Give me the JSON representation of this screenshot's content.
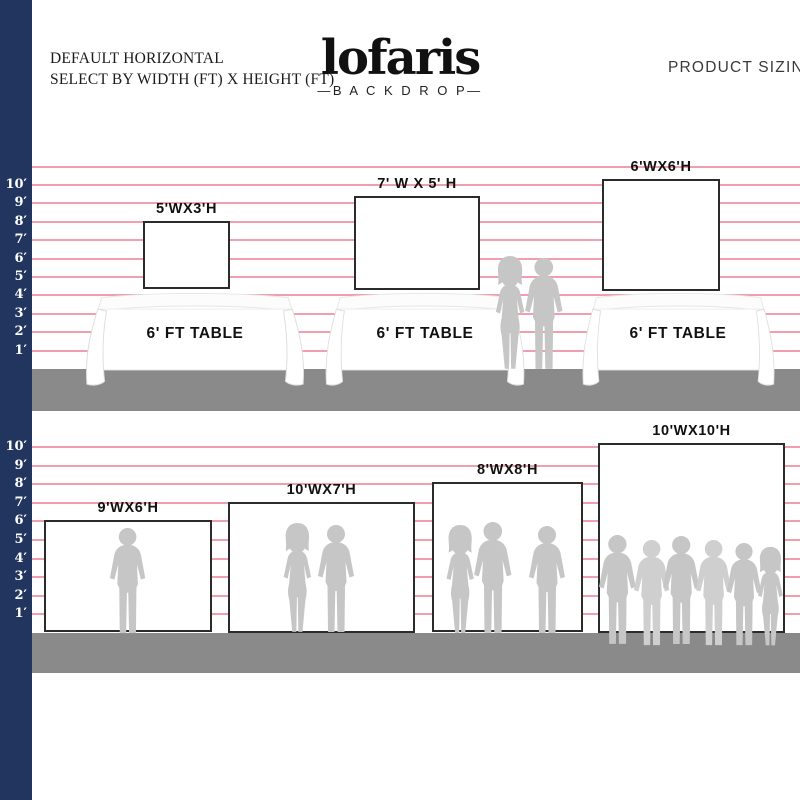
{
  "header": {
    "left_line1": "DEFAULT HORIZONTAL",
    "left_line2": "SELECT BY WIDTH (FT) X HEIGHT (FT)",
    "logo": "lofaris",
    "logo_sub": "—B A C K D R O P—",
    "right": "PRODUCT SIZING"
  },
  "colors": {
    "navy": "#22355f",
    "pink": "#ef9fae",
    "floor": "#8a8a8a",
    "silhouette": "#c6c6c6",
    "border": "#2b2b2b"
  },
  "ruler": {
    "labels": [
      "10′",
      "9′",
      "8′",
      "7′",
      "6′",
      "5′",
      "4′",
      "3′",
      "2′",
      "1′"
    ]
  },
  "sections": [
    {
      "id": "tables-row",
      "floor_top": 369,
      "floor_height": 42,
      "foot_px": 18.4,
      "feet_lines": 11,
      "backdrops": [
        {
          "label": "5'WX3'H",
          "x": 143,
          "y": 221,
          "w": 87,
          "h": 68
        },
        {
          "label": "7' W X 5' H",
          "x": 354,
          "y": 196,
          "w": 126,
          "h": 94
        },
        {
          "label": "6'WX6'H",
          "x": 602,
          "y": 179,
          "w": 118,
          "h": 112
        }
      ],
      "tables": [
        {
          "label": "6' FT TABLE",
          "cx": 195,
          "base_w": 214
        },
        {
          "label": "6' FT TABLE",
          "cx": 425,
          "base_w": 194
        },
        {
          "label": "6' FT TABLE",
          "cx": 678,
          "base_w": 187
        }
      ],
      "table_top_y": 292,
      "table_height": 95,
      "table_label_y": 325,
      "people": [
        {
          "type": "woman",
          "cx": 510,
          "top": 255,
          "h": 118
        },
        {
          "type": "man",
          "cx": 544,
          "top": 257,
          "h": 116
        }
      ]
    },
    {
      "id": "backdrops-row",
      "floor_top": 633,
      "floor_height": 40,
      "foot_px": 18.6,
      "feet_lines": 10,
      "backdrops": [
        {
          "label": "9'WX6'H",
          "x": 44,
          "y": 520,
          "w": 168,
          "h": 112
        },
        {
          "label": "10'WX7'H",
          "x": 228,
          "y": 502,
          "w": 187,
          "h": 131
        },
        {
          "label": "8'WX8'H",
          "x": 432,
          "y": 482,
          "w": 151,
          "h": 150
        },
        {
          "label": "10'WX10'H",
          "x": 598,
          "y": 443,
          "w": 187,
          "h": 190
        }
      ],
      "tables": [],
      "people": [
        {
          "type": "man",
          "cx": 128,
          "top": 527,
          "h": 110
        },
        {
          "type": "woman",
          "cx": 297,
          "top": 522,
          "h": 114
        },
        {
          "type": "man",
          "cx": 336,
          "top": 524,
          "h": 112
        },
        {
          "type": "woman",
          "cx": 460,
          "top": 524,
          "h": 113
        },
        {
          "type": "man",
          "cx": 493,
          "top": 521,
          "h": 116
        },
        {
          "type": "man",
          "cx": 547,
          "top": 525,
          "h": 112
        },
        {
          "type": "man",
          "cx": 617,
          "top": 534,
          "h": 114
        },
        {
          "type": "man",
          "cx": 652,
          "top": 539,
          "h": 110,
          "shade": "#cfcfcf"
        },
        {
          "type": "man",
          "cx": 681,
          "top": 535,
          "h": 113
        },
        {
          "type": "man",
          "cx": 714,
          "top": 539,
          "h": 110,
          "shade": "#cfcfcf"
        },
        {
          "type": "man",
          "cx": 744,
          "top": 542,
          "h": 107
        },
        {
          "type": "woman",
          "cx": 770,
          "top": 546,
          "h": 103
        }
      ]
    }
  ]
}
